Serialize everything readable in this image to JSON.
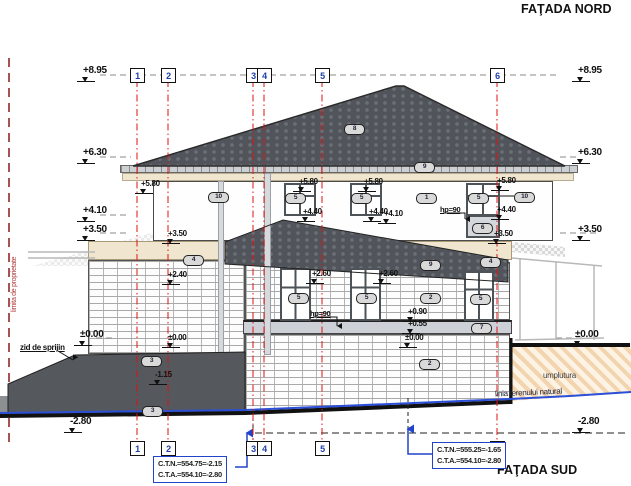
{
  "titles": {
    "north": "FAŢADA NORD",
    "south": "FAŢADA SUD"
  },
  "annotations": {
    "property_line": "limita de proprietate",
    "retaining_wall": "zid de sprijin",
    "fill_label": "umplutura",
    "terrain_label": "linia terenului natural"
  },
  "info_boxes": [
    {
      "lines": [
        "C.T.N.=554.75=-2.15",
        "C.T.A.=554.10=-2.80"
      ],
      "x": 153,
      "y": 456
    },
    {
      "lines": [
        "C.T.N.=555.25=-1.65",
        "C.T.A.=554.10=-2.80"
      ],
      "x": 432,
      "y": 442
    }
  ],
  "grid_columns": [
    {
      "label": "1",
      "x": 137
    },
    {
      "label": "2",
      "x": 168
    },
    {
      "label": "3",
      "x": 253
    },
    {
      "label": "4",
      "x": 264
    },
    {
      "label": "5",
      "x": 322
    },
    {
      "label": "6",
      "x": 497
    }
  ],
  "elevation_labels": [
    {
      "text": "+8.95",
      "x": 83,
      "y": 66,
      "size": "lg"
    },
    {
      "text": "+6.30",
      "x": 83,
      "y": 148,
      "size": "lg"
    },
    {
      "text": "+4.10",
      "x": 83,
      "y": 206,
      "size": "lg"
    },
    {
      "text": "+3.50",
      "x": 83,
      "y": 225,
      "size": "lg"
    },
    {
      "text": "±0.00",
      "x": 80,
      "y": 330,
      "size": "lg"
    },
    {
      "text": "-2.80",
      "x": 70,
      "y": 417,
      "size": "lg"
    },
    {
      "text": "+8.95",
      "x": 578,
      "y": 66,
      "size": "lg"
    },
    {
      "text": "+6.30",
      "x": 578,
      "y": 148,
      "size": "lg"
    },
    {
      "text": "+3.50",
      "x": 578,
      "y": 225,
      "size": "lg"
    },
    {
      "text": "±0.00",
      "x": 575,
      "y": 330,
      "size": "lg"
    },
    {
      "text": "-2.80",
      "x": 578,
      "y": 417,
      "size": "lg"
    },
    {
      "text": "+5.80",
      "x": 141,
      "y": 180,
      "size": "sm"
    },
    {
      "text": "+5.80",
      "x": 299,
      "y": 178,
      "size": "sm"
    },
    {
      "text": "+5.80",
      "x": 364,
      "y": 178,
      "size": "sm"
    },
    {
      "text": "+5.80",
      "x": 497,
      "y": 177,
      "size": "sm"
    },
    {
      "text": "+4.40",
      "x": 303,
      "y": 208,
      "size": "sm"
    },
    {
      "text": "+4.40",
      "x": 369,
      "y": 208,
      "size": "sm"
    },
    {
      "text": "+4.40",
      "x": 497,
      "y": 206,
      "size": "sm"
    },
    {
      "text": "+4.10",
      "x": 384,
      "y": 210,
      "size": "sm"
    },
    {
      "text": "+3.50",
      "x": 168,
      "y": 230,
      "size": "sm"
    },
    {
      "text": "+3.50",
      "x": 494,
      "y": 230,
      "size": "sm"
    },
    {
      "text": "+2.40",
      "x": 168,
      "y": 271,
      "size": "sm"
    },
    {
      "text": "+2.60",
      "x": 312,
      "y": 270,
      "size": "sm"
    },
    {
      "text": "+2.60",
      "x": 379,
      "y": 270,
      "size": "sm"
    },
    {
      "text": "+0.90",
      "x": 408,
      "y": 308,
      "size": "sm"
    },
    {
      "text": "+0.55",
      "x": 408,
      "y": 320,
      "size": "sm"
    },
    {
      "text": "±0.00",
      "x": 168,
      "y": 334,
      "size": "sm"
    },
    {
      "text": "±0.00",
      "x": 405,
      "y": 334,
      "size": "sm"
    },
    {
      "text": "-1.15",
      "x": 155,
      "y": 371,
      "size": "sm"
    }
  ],
  "hp_labels": [
    {
      "text": "hp=90",
      "x": 440,
      "y": 205
    },
    {
      "text": "hp=90",
      "x": 310,
      "y": 309
    }
  ],
  "component_markers": [
    {
      "label": "8",
      "x": 344,
      "y": 124
    },
    {
      "label": "9",
      "x": 414,
      "y": 162
    },
    {
      "label": "10",
      "x": 208,
      "y": 192
    },
    {
      "label": "5",
      "x": 285,
      "y": 193
    },
    {
      "label": "5",
      "x": 351,
      "y": 193
    },
    {
      "label": "1",
      "x": 416,
      "y": 193
    },
    {
      "label": "5",
      "x": 468,
      "y": 193
    },
    {
      "label": "10",
      "x": 514,
      "y": 192
    },
    {
      "label": "6",
      "x": 472,
      "y": 223
    },
    {
      "label": "4",
      "x": 183,
      "y": 255
    },
    {
      "label": "4",
      "x": 480,
      "y": 257
    },
    {
      "label": "9",
      "x": 420,
      "y": 260
    },
    {
      "label": "5",
      "x": 288,
      "y": 293
    },
    {
      "label": "5",
      "x": 356,
      "y": 293
    },
    {
      "label": "2",
      "x": 420,
      "y": 293
    },
    {
      "label": "5",
      "x": 470,
      "y": 294
    },
    {
      "label": "7",
      "x": 471,
      "y": 323
    },
    {
      "label": "2",
      "x": 419,
      "y": 359
    },
    {
      "label": "3",
      "x": 141,
      "y": 356
    },
    {
      "label": "3",
      "x": 142,
      "y": 406
    }
  ],
  "colors": {
    "grid_red": "#e11111",
    "property_red": "#8b1a1a",
    "terrain_blue": "#2b4fd7",
    "box_blue": "#2244cc",
    "roof_dark": "#51555b",
    "wall_cream": "#f0e6cf",
    "concrete": "#cdd1d7",
    "retaining_gray": "#55585c",
    "fill_tan": "#f2d4ae"
  }
}
